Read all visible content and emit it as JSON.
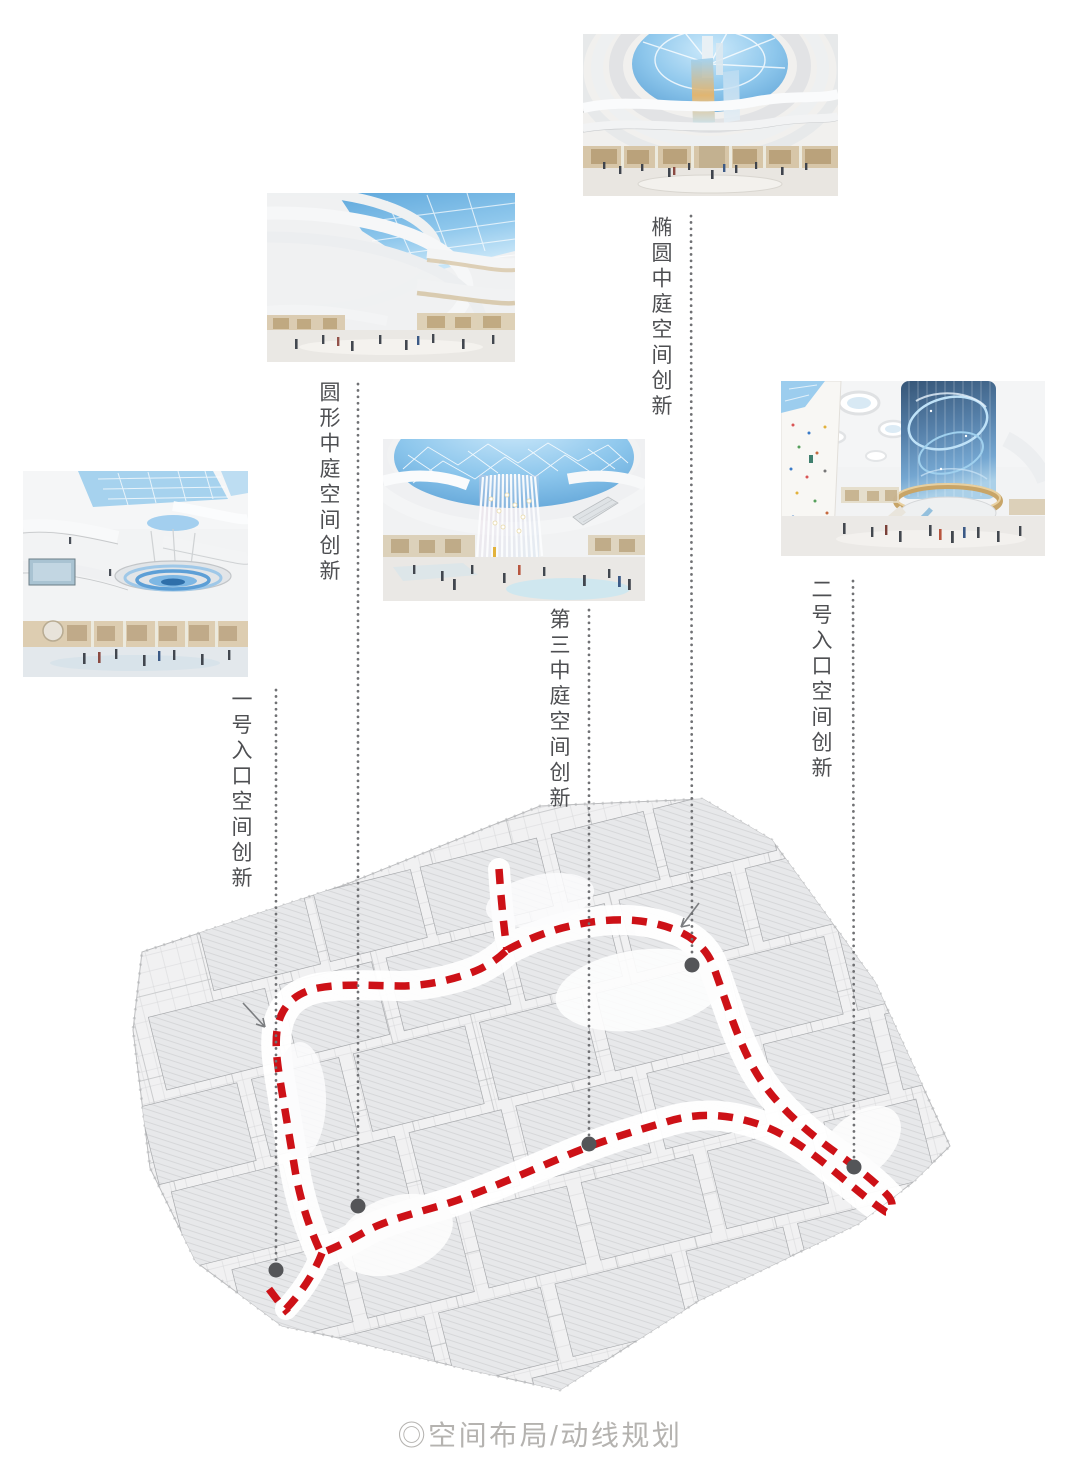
{
  "page": {
    "caption": "◎空间布局/动线规划"
  },
  "colors": {
    "route_red": "#cd1117",
    "leader_dot_gray": "#707174",
    "pin_gray": "#545558",
    "label_text": "#4e4f52",
    "caption_gray": "#b5b3b0",
    "plan_fill": "#f1f1f2",
    "plan_block_line": "#a8aaad"
  },
  "annotations": [
    {
      "id": "elliptical-atrium",
      "text": "椭圆中庭空间创新"
    },
    {
      "id": "circular-atrium",
      "text": "圆形中庭空间创新"
    },
    {
      "id": "entrance-1",
      "text": "一号入口空间创新"
    },
    {
      "id": "third-atrium",
      "text": "第三中庭空间创新"
    },
    {
      "id": "entrance-2",
      "text": "二号入口空间创新"
    }
  ],
  "photos": [
    {
      "name": "elliptical-atrium-render"
    },
    {
      "name": "circular-atrium-render"
    },
    {
      "name": "entrance-1-atrium-render"
    },
    {
      "name": "third-atrium-render"
    },
    {
      "name": "entrance-2-space-render"
    }
  ],
  "plan": {
    "name": "level-floor-plan",
    "route": "red-dashed-circulation-loop",
    "marker_count": 5
  }
}
